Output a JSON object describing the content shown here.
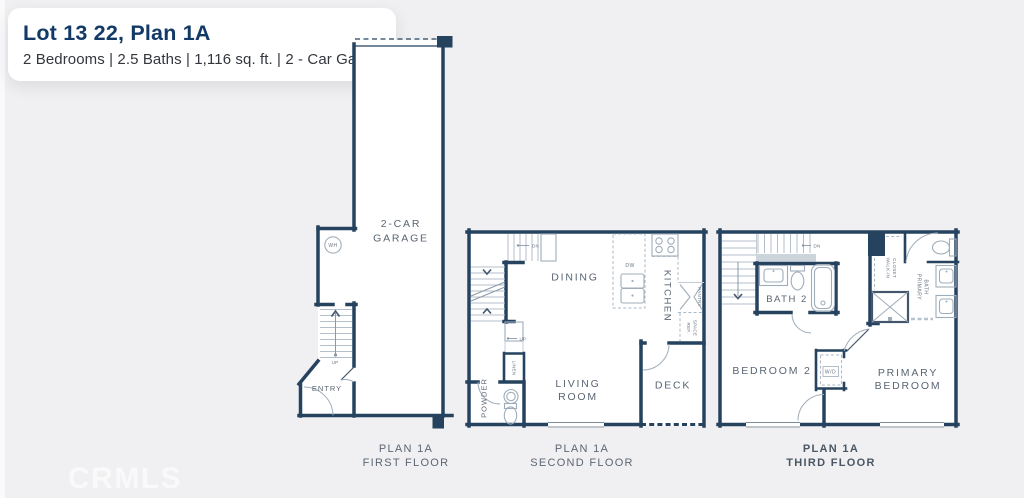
{
  "header": {
    "title": "Lot 13 22, Plan 1A",
    "subtitle": "2 Bedrooms | 2.5 Baths | 1,116 sq. ft. | 2 - Car Garage"
  },
  "watermark": "CRMLS",
  "colors": {
    "background": "#f0f0f2",
    "card": "#ffffff",
    "wall_navy": "#25425f",
    "title_navy": "#123a66",
    "subtitle_dark": "#33363d",
    "room_label_gray": "#5a6573",
    "fixture_gray": "#9fadba"
  },
  "f1": {
    "garage1": "2-CAR",
    "garage2": "GARAGE",
    "entry": "ENTRY",
    "wh": "WH",
    "up": "UP"
  },
  "f2": {
    "dn": "DN",
    "up": "UP",
    "dining": "DINING",
    "kitchen": "KITCHEN",
    "dw": "DW",
    "pantry": "PANTRY",
    "ref1": "REF.",
    "ref2": "SPACE",
    "linen": "LINEN",
    "powder": "POWDER",
    "living1": "LIVING",
    "living2": "ROOM",
    "deck": "DECK"
  },
  "f3": {
    "dn": "DN",
    "bath2": "BATH 2",
    "walkin1": "WALK-IN",
    "walkin2": "CLOSET",
    "pbath1": "PRIMARY",
    "pbath2": "BATH",
    "bedroom2": "BEDROOM 2",
    "wd": "W/D",
    "pbed1": "PRIMARY",
    "pbed2": "BEDROOM"
  },
  "captions": [
    {
      "l1": "PLAN 1A",
      "l2": "FIRST FLOOR"
    },
    {
      "l1": "PLAN 1A",
      "l2": "SECOND FLOOR"
    },
    {
      "l1": "PLAN 1A",
      "l2": "THIRD FLOOR"
    }
  ]
}
